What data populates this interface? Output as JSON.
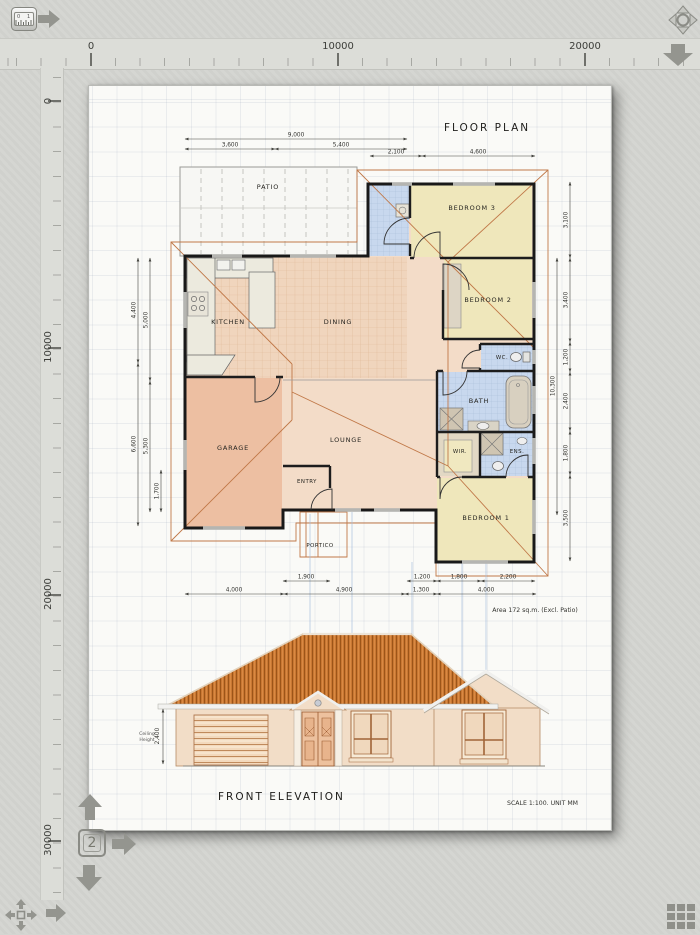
{
  "rulers": {
    "horizontal_labels": [
      "0",
      "10000",
      "20000"
    ],
    "vertical_labels": [
      "0",
      "10000",
      "20000",
      "30000"
    ]
  },
  "nav": {
    "page_number": "2"
  },
  "drawing": {
    "floor_plan": {
      "title": "FLOOR PLAN",
      "rooms": {
        "patio": "PATIO",
        "kitchen": "KITCHEN",
        "dining": "DINING",
        "garage": "GARAGE",
        "lounge": "LOUNGE",
        "entry": "ENTRY",
        "portico": "PORTICO",
        "bed3": "BEDROOM 3",
        "bed2": "BEDROOM 2",
        "wc": "WC.",
        "bath": "BATH",
        "wir": "WIR.",
        "ens": "ENS.",
        "bed1": "BEDROOM 1"
      },
      "dims_top": [
        "9,000",
        "3,600",
        "5,400",
        "2,100",
        "4,600"
      ],
      "dims_left": [
        "4,400",
        "5,000",
        "6,600",
        "5,300",
        "1,700"
      ],
      "dims_right": [
        "3,100",
        "3,400",
        "1,200",
        "2,400",
        "1,800",
        "3,500",
        "10,300"
      ],
      "dims_bottom": [
        "1,900",
        "1,200",
        "1,800",
        "2,200",
        "4,000",
        "4,900",
        "1,300",
        "4,000"
      ],
      "area_note": "Area 172 sq.m.  (Excl. Patio)"
    },
    "elevation": {
      "title": "FRONT ELEVATION",
      "ceiling_label_1": "Ceiling",
      "ceiling_label_2": "Height",
      "ceiling_value": "2,400",
      "scale_note": "SCALE 1:100.  UNIT MM"
    }
  },
  "colors": {
    "app_background": "#d4d5d1",
    "paper": "#fafaf7",
    "wall": "#191919",
    "floor_tile": "#f0d5bd",
    "garage_fill": "#edbfa2",
    "lounge_fill": "#f3dcc8",
    "bedroom_fill": "#efe7bb",
    "wet_area_fill": "#c8d8ee",
    "roof_line": "#c07848",
    "elevation_roof": "#c97732",
    "elevation_wall": "#f2ddc7",
    "projection_line": "#a6bedd",
    "chrome_icon": "#94958f"
  }
}
